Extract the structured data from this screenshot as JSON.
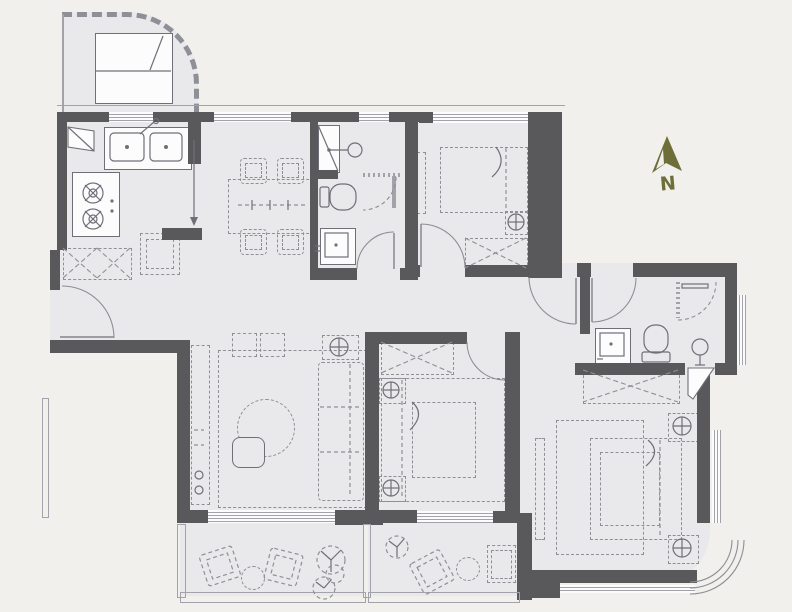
{
  "palette": {
    "bg": "#f2f0ec",
    "floor": "#e9e9eb",
    "wall": "#59595b",
    "line": "#8f8f97",
    "fixture": "#6f6f78",
    "winline": "#a2a2aa",
    "accent": "#6e6e38",
    "white": "#fcfcfd"
  },
  "compass": {
    "label": "N",
    "icon": "north-arrow-icon"
  },
  "plan": {
    "type": "apartment-floor-plan",
    "rooms": [
      "terrace",
      "kitchen",
      "entry",
      "dining-area",
      "bathroom",
      "bedroom-1",
      "hallway",
      "living-room",
      "bedroom-2",
      "vestibule",
      "ensuite-bathroom",
      "master-bedroom",
      "balcony-1",
      "balcony-2"
    ]
  }
}
